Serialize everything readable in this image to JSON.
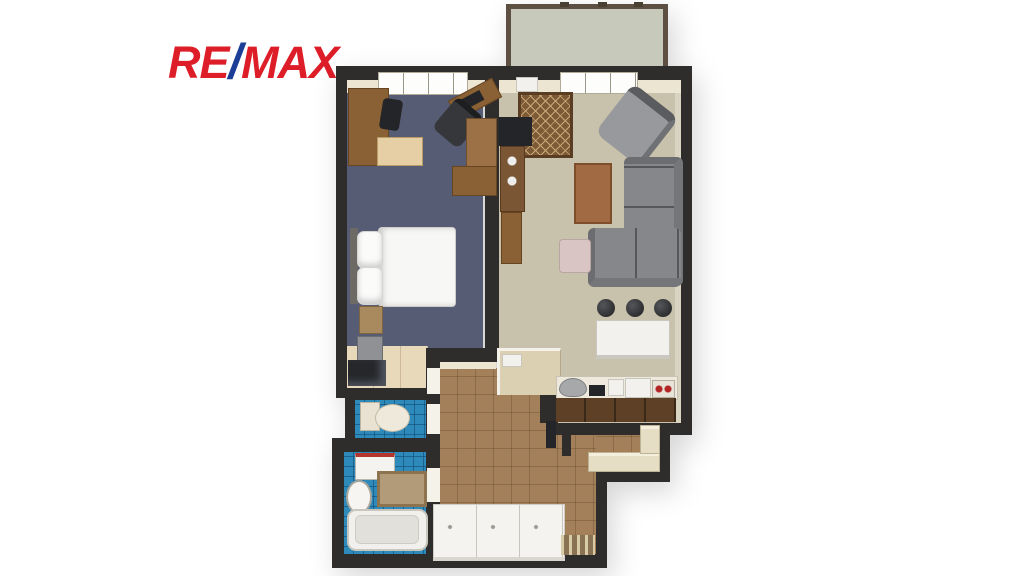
{
  "brand": {
    "part_re": "RE",
    "part_slash": "/",
    "part_max": "MAX"
  },
  "colors": {
    "logoRed": "#dd1d27",
    "logoBlue": "#1c3e97",
    "wall": "#2e2d2b",
    "wallFace": "#ece5d2",
    "bedroomFloor": "#565c73",
    "livingFloor": "#c8c1ab",
    "entryWood": "#e9d9bb",
    "hallTile": "#a3805a",
    "blueTile": "#2f8abc",
    "balconyFloor": "#c7cabb",
    "balconyBorder": "#5d5043",
    "woodMid": "#8a6134",
    "woodDark": "#5d4026",
    "sofaGray": "#85878b",
    "rugBrown": "#7d5a36",
    "rugLight": "#c9a877",
    "darkItem": "#242528"
  },
  "floor_plan": {
    "type": "apartment-top-view-3d-render",
    "rooms": [
      {
        "id": "balcony",
        "floor": "balconyFloor",
        "furniture": []
      },
      {
        "id": "bedroom",
        "floor": "bedroomFloor",
        "furniture": [
          "desk",
          "desk-chair",
          "dresser",
          "office-chair",
          "corner-desk",
          "shelf-unit",
          "sideboard",
          "double-bed",
          "nightstand",
          "stool",
          "vanity"
        ]
      },
      {
        "id": "living-room-kitchen",
        "floor": "livingFloor",
        "furniture": [
          "rug",
          "tv",
          "tv-stand",
          "shelf-unit",
          "armchair",
          "coffee-table",
          "corner-sofa",
          "ottoman",
          "dining-table",
          "bar-stool",
          "bar-stool",
          "bar-stool",
          "kitchen-counter",
          "cooktop",
          "appliances"
        ]
      },
      {
        "id": "hallway",
        "floor": "hallTile",
        "furniture": [
          "wardrobe",
          "entry-cabinet",
          "doormat",
          "open-door"
        ]
      },
      {
        "id": "wc",
        "floor": "blueTile",
        "furniture": [
          "toilet"
        ]
      },
      {
        "id": "bathroom",
        "floor": "blueTile",
        "furniture": [
          "washing-machine",
          "sink",
          "bath-mat",
          "bathtub"
        ]
      }
    ]
  }
}
